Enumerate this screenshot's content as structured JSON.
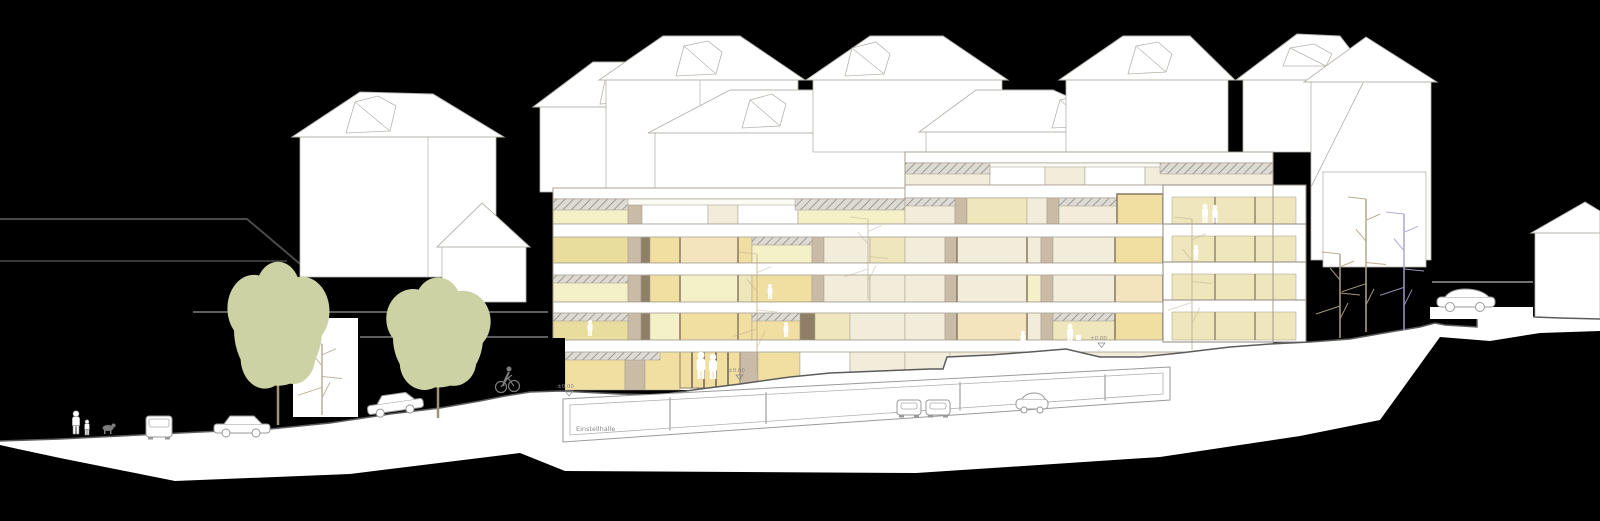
{
  "document": {
    "type": "architectural elevation / street section",
    "description": "Street elevation of a 6-storey residential building with lit windows, underground parking garage, background houses with hipped roofs and skylights, street trees, cars, pedestrians, a cyclist and a dog on a sloping street.",
    "background_color": "#000000"
  },
  "labels": {
    "garage_label": "Einstellhalle",
    "marker_1": "±0.00",
    "marker_2": "±0.00",
    "marker_3": "±0.00"
  },
  "palette": {
    "paper": "#ffffff",
    "floor_base": "#fbfaf5",
    "line": "#a39a8c",
    "line_gray": "#9a9590",
    "dark_line": "#5c5c5c",
    "glass": "#f0dfa0",
    "glassg": "#e9dd9d",
    "glass2": "#efe6bb",
    "pale": "#f4f0c8",
    "cream": "#f2ecdb",
    "creamy": "#f3e4bd",
    "pier": "#c9bba5",
    "frame": "#8f7f67",
    "white": "#ffffff",
    "hatch": "#8f8b84",
    "tree_green": "#ccd2a3",
    "tree_bark": "#b5a68b",
    "tree_purple": "#aaa2cf",
    "figure_white": "#ffffff",
    "figure_gray": "#7d7d7d",
    "house_stroke": "#b8b4ae"
  },
  "scene": {
    "building": {
      "sections": 2,
      "floors_left": 6,
      "floors_right": 7,
      "underground_levels": 1,
      "bay_windows": true,
      "roof_terraces_hatched": true
    },
    "background_houses": 10,
    "roof_skylights": 8,
    "street_trees_green": 2,
    "bare_trees": 4,
    "street_vehicles": [
      "van-rear",
      "sedan",
      "sedan",
      "suv"
    ],
    "garage_vehicles": 3,
    "pedestrians": 2,
    "dog": 1,
    "cyclist": 1,
    "people_in_building": 10
  }
}
